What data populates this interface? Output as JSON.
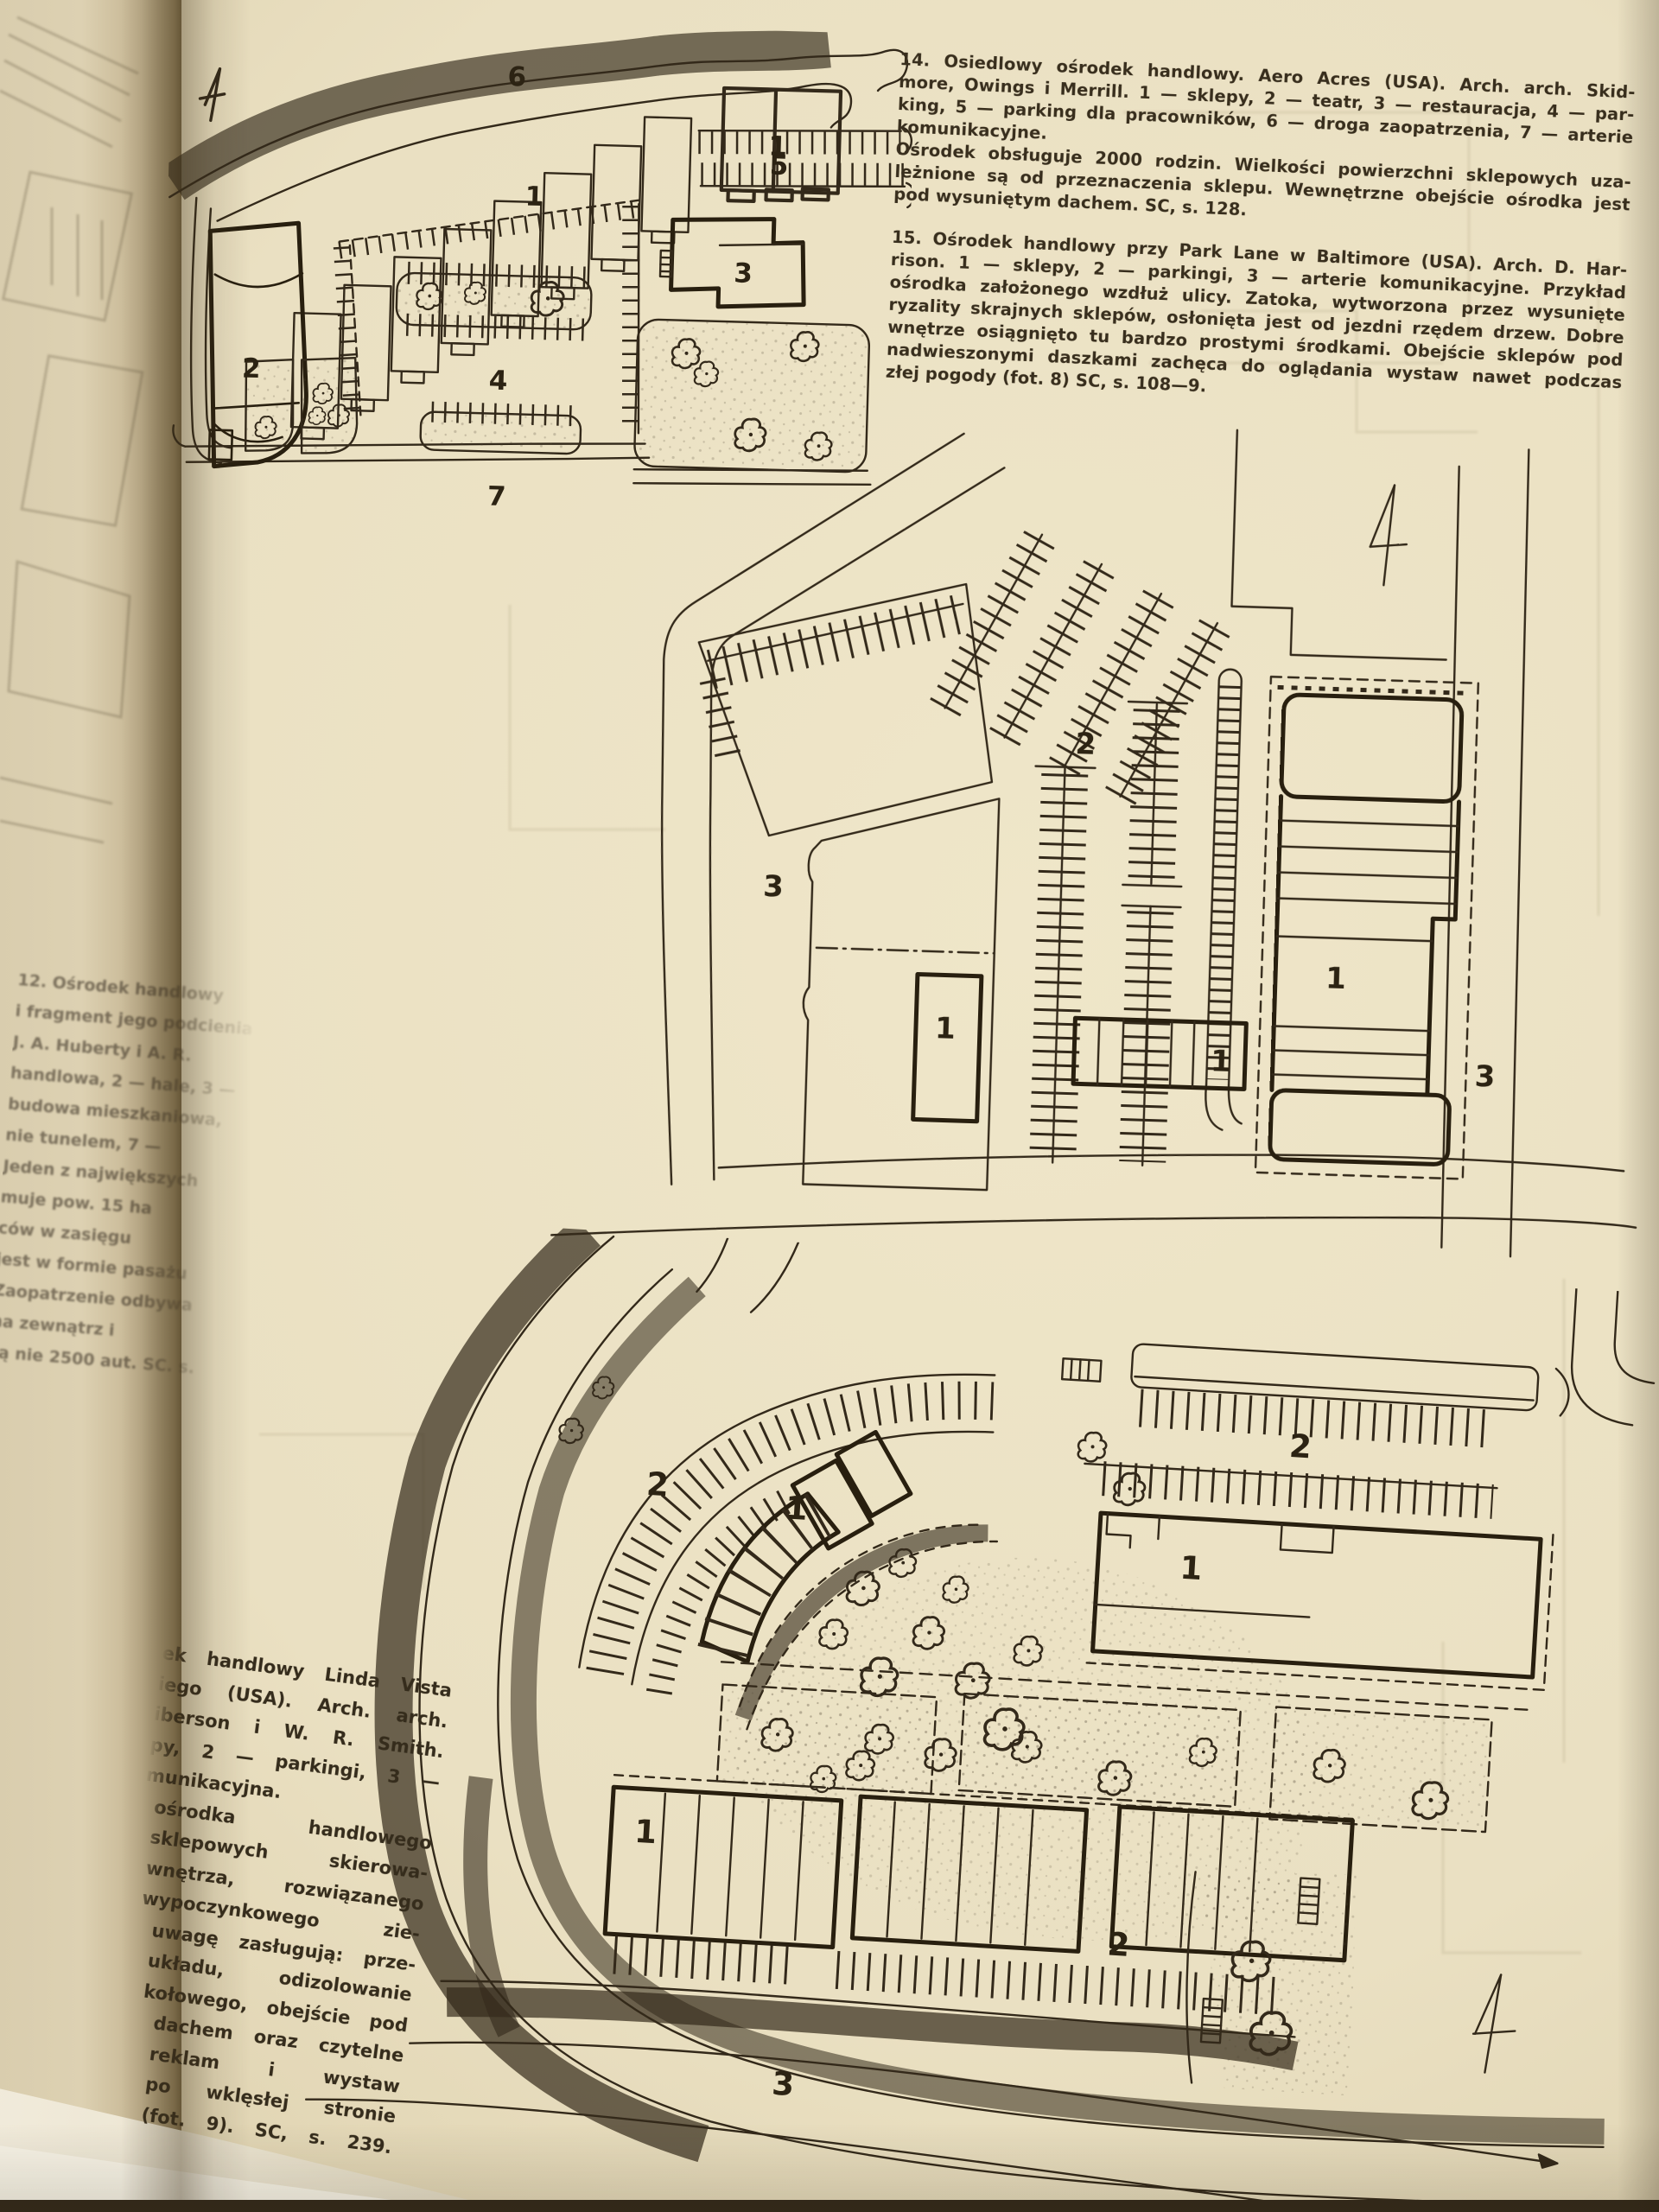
{
  "captions": {
    "fig14": {
      "lines": [
        "14. Osiedlowy ośrodek handlowy. Aero Acres (USA). Arch. arch. Skid-",
        "more, Owings i Merrill. 1 — sklepy, 2 — teatr, 3 — restauracja, 4 — par-",
        "king, 5 — parking dla pracowników, 6 — droga zaopatrzenia, 7 — arterie",
        "komunikacyjne.",
        "Ośrodek obsługuje 2000 rodzin. Wielkości powierzchni sklepowych uza-",
        "leżnione są od przeznaczenia sklepu. Wewnętrzne obejście ośrodka jest",
        "pod wysuniętym dachem. SC, s. 128."
      ]
    },
    "fig15": {
      "lines": [
        "15. Ośrodek handlowy przy Park Lane w Baltimore (USA). Arch. D. Har-",
        "rison. 1 — sklepy, 2 — parkingi, 3 — arterie komunikacyjne. Przykład",
        "ośrodka założonego wzdłuż ulicy. Zatoka, wytworzona przez wysunięte",
        "ryzality skrajnych sklepów, osłonięta jest od jezdni rzędem drzew. Dobre",
        "wnętrze osiągnięto tu bardzo prostymi środkami. Obejście sklepów pod",
        "nadwieszonymi daszkami zachęca do oglądania wystaw nawet podczas",
        "złej pogody (fot. 8) SC, s. 108—9."
      ]
    },
    "fig12_partial": {
      "lines": [
        "12. Ośrodek handlowy",
        "i fragment jego podcienia",
        "J. A. Huberty i A. R.",
        "handlowa, 2 — hale, 3 —",
        "budowa mieszkaniowa,",
        "nie tunelem, 7 —",
        "Jeden z największych",
        "muje pow. 15 ha",
        "ców w zasięgu",
        "jest w formie pasażu",
        "Zaopatrzenie odbywa",
        "na zewnątrz i",
        "są nie 2500 aut. SC. s."
      ]
    },
    "fig13_partial": {
      "lines": [
        "ek handlowy Linda Vista",
        "iego (USA). Arch. arch.",
        "iberson i W. R. Smith.",
        "py, 2 — parkingi, 3 —",
        "munikacyjna.",
        "ośrodka handlowego",
        "sklepowych skierowa-",
        "wnętrza, rozwiązanego",
        "wypoczynkowego zie-",
        "uwagę zasługują: prze-",
        "układu, odizolowanie",
        "kołowego, obejście pod",
        "dachem oraz czytelne",
        "reklam i wystaw",
        "po wklęsłej stronie",
        "(fot. 9). SC, s. 239."
      ]
    }
  },
  "diagrams": {
    "fig14": {
      "labels": {
        "shops_a": "1",
        "shops_b": "1",
        "theater": "2",
        "restaurant": "3",
        "parking_center": "4",
        "parking_staff": "5",
        "road_top": "6",
        "road_bottom": "7"
      }
    },
    "fig15": {
      "labels": {
        "shops_main": "1",
        "shop_left": "1",
        "shop_striped": "1",
        "parking": "2",
        "road_left": "3",
        "road_right": "3"
      }
    },
    "fig13": {
      "labels": {
        "shops_arc": "1",
        "building_right": "1",
        "buildings_bottom": "1",
        "parking_arc": "2",
        "parking_right": "2",
        "parking_bottom": "2",
        "road": "3"
      }
    }
  },
  "colors": {
    "paper": "#eae0c2",
    "paper_shadow": "#cfc19b",
    "ink": "#33291a",
    "left_page": "#d9cdae"
  }
}
